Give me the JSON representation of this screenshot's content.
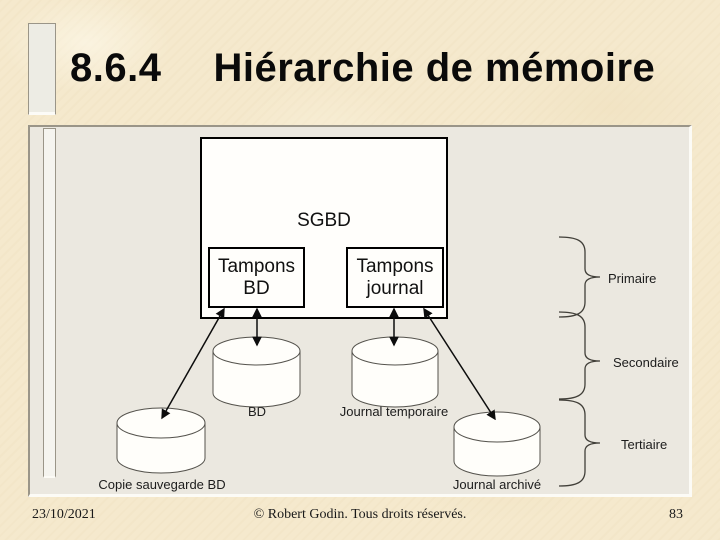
{
  "slide": {
    "title_number": "8.6.4",
    "title_text": "Hiérarchie de mémoire",
    "footer": {
      "date": "23/10/2021",
      "copyright": "© Robert Godin. Tous droits réservés.",
      "page_number": "83"
    }
  },
  "diagram": {
    "sgbd_label": "SGBD",
    "buffers": [
      {
        "line1": "Tampons",
        "line2": "BD"
      },
      {
        "line1": "Tampons",
        "line2": "journal"
      }
    ],
    "cylinders": [
      {
        "label": "BD"
      },
      {
        "label": "Journal temporaire"
      },
      {
        "label": "Copie sauvegarde BD"
      },
      {
        "label": "Journal archivé"
      }
    ],
    "memory_tiers": [
      {
        "label": "Primaire"
      },
      {
        "label": "Secondaire"
      },
      {
        "label": "Tertiaire"
      }
    ]
  },
  "colors": {
    "slide_background": "#f5e9cd",
    "panel_background": "#ebe8e0",
    "diagram_fill": "#fffefa",
    "line_color": "#0d0d0d"
  }
}
